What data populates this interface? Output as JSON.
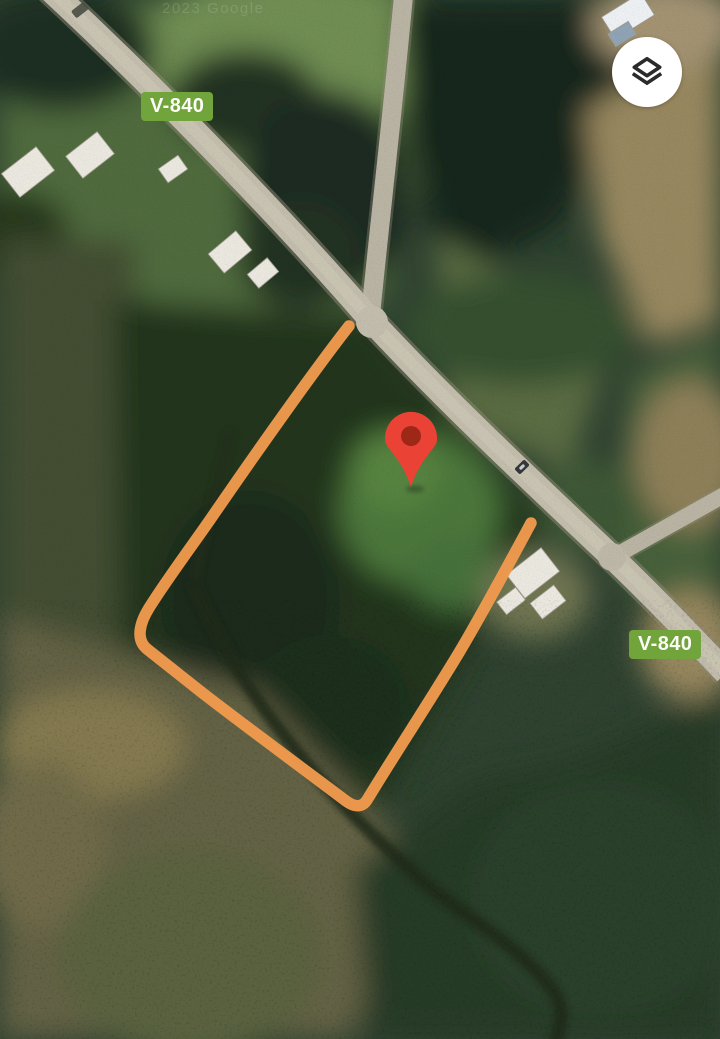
{
  "map": {
    "watermark": "2023 Google",
    "road_labels": {
      "top": "V-840",
      "bottom": "V-840"
    },
    "colors": {
      "badge_green": "#72A43C",
      "boundary_orange": "#F09A4E",
      "pin_red": "#EA4335",
      "pin_inner_red": "#9D2817",
      "road_grey": "#C2BCAC"
    }
  },
  "controls": {
    "layers_icon": "layers-icon"
  }
}
